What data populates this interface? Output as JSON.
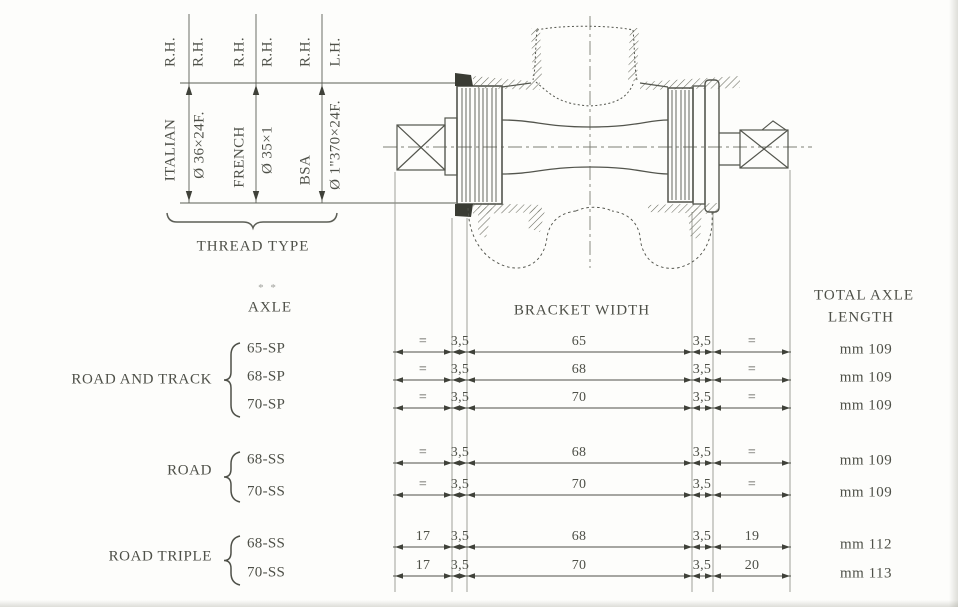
{
  "page": {
    "background": "#fdfdfb",
    "ink": "#4e5048"
  },
  "thread_section": {
    "hand_labels": [
      "R.H.",
      "R.H.",
      "R.H.",
      "R.H.",
      "R.H.",
      "L.H."
    ],
    "type_labels": [
      "ITALIAN",
      "Ø 36×24F.",
      "FRENCH",
      "Ø 35×1",
      "BSA",
      "Ø 1\"370×24F."
    ],
    "caption": "THREAD TYPE"
  },
  "drawing": {
    "name": "bottom-bracket-axle-assembly-cross-section"
  },
  "table": {
    "axle_header": "AXLE",
    "axle_header_mark": "* *",
    "bracket_width_header": "BRACKET WIDTH",
    "total_length_header_line1": "TOTAL AXLE",
    "total_length_header_line2": "LENGTH",
    "groups": [
      {
        "label": "ROAD AND TRACK",
        "rows": [
          0,
          1,
          2
        ]
      },
      {
        "label": "ROAD",
        "rows": [
          3,
          4
        ]
      },
      {
        "label": "ROAD TRIPLE",
        "rows": [
          5,
          6
        ]
      }
    ],
    "rows": [
      {
        "code": "65-SP",
        "segments": [
          "=",
          "3,5",
          "65",
          "3,5",
          "="
        ],
        "total": "mm 109"
      },
      {
        "code": "68-SP",
        "segments": [
          "=",
          "3,5",
          "68",
          "3,5",
          "="
        ],
        "total": "mm 109"
      },
      {
        "code": "70-SP",
        "segments": [
          "=",
          "3,5",
          "70",
          "3,5",
          "="
        ],
        "total": "mm 109"
      },
      {
        "code": "68-SS",
        "segments": [
          "=",
          "3,5",
          "68",
          "3,5",
          "="
        ],
        "total": "mm 109"
      },
      {
        "code": "70-SS",
        "segments": [
          "=",
          "3,5",
          "70",
          "3,5",
          "="
        ],
        "total": "mm 109"
      },
      {
        "code": "68-SS",
        "segments": [
          "17",
          "3,5",
          "68",
          "3,5",
          "19"
        ],
        "total": "mm 112"
      },
      {
        "code": "70-SS",
        "segments": [
          "17",
          "3,5",
          "70",
          "3,5",
          "20"
        ],
        "total": "mm 113"
      }
    ]
  }
}
